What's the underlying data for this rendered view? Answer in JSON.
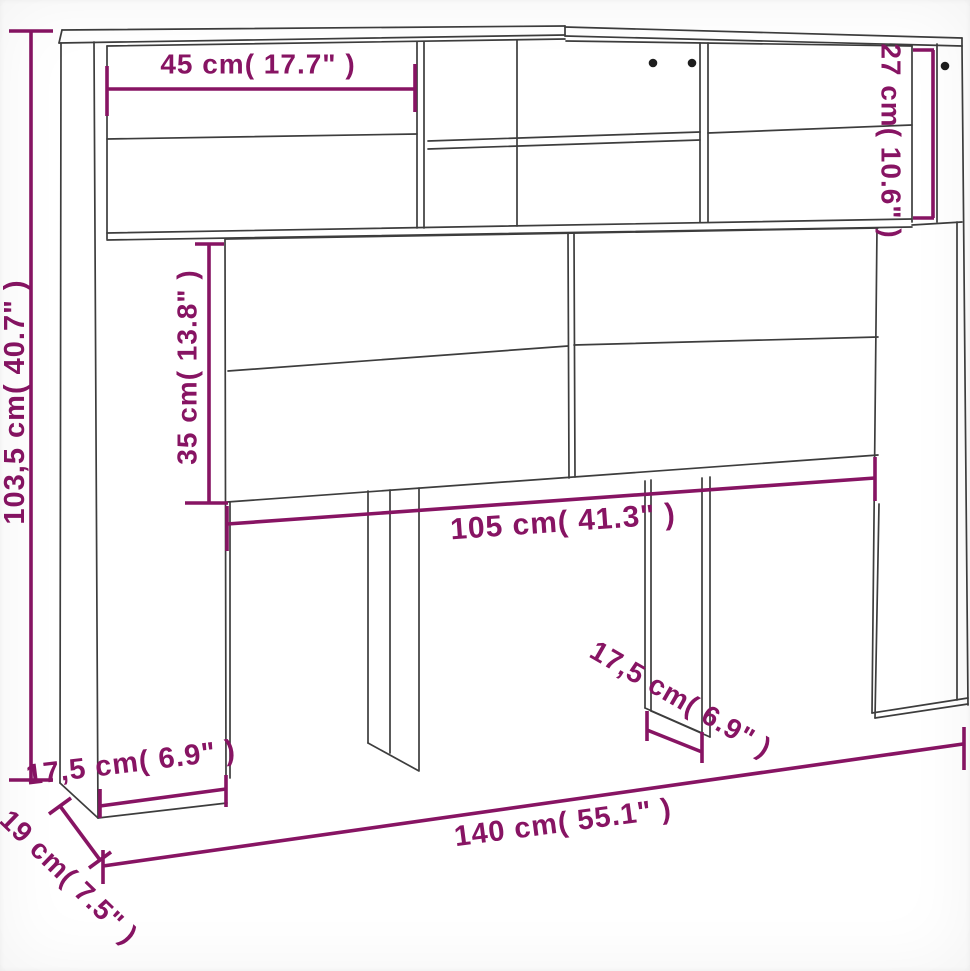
{
  "measurements": {
    "overall_height": "103,5 cm( 40.7\" )",
    "top_shelf_width": "45 cm( 17.7\" )",
    "top_section_height": "27 cm( 10.6\" )",
    "door_section_height": "35 cm( 13.8\" )",
    "door_section_width": "105 cm( 41.3\" )",
    "base_depth_left": "17,5 cm( 6.9\" )",
    "base_depth_center": "17,5 cm( 6.9\" )",
    "overall_width": "140 cm( 55.1\" )",
    "overall_depth": "19 cm( 7.5\" )"
  },
  "colors": {
    "dimension": "#871463",
    "line": "#3d3d3d",
    "dot": "#1e1e1e",
    "background": "#ffffff"
  }
}
